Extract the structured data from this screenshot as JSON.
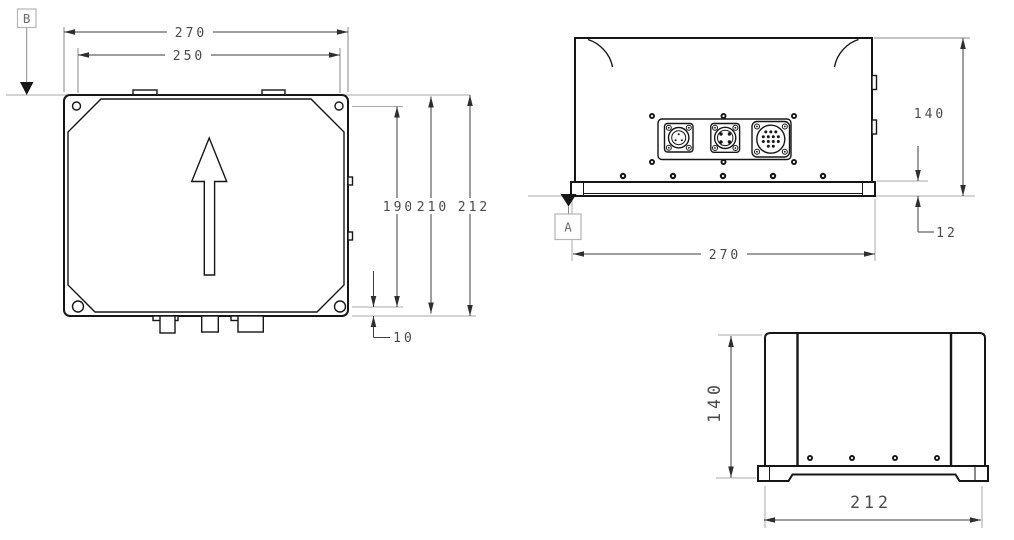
{
  "canvas": {
    "background": "#ffffff",
    "outline_color": "#161616",
    "dimension_line_color": "#3d3d3d",
    "dimension_text_color": "#4a4a4a",
    "extension_line_color": "#a9a9a9"
  },
  "top_view": {
    "datum_label": "B",
    "dim_outer_width": "270",
    "dim_inner_width": "250",
    "dim_hole_span_height": "190",
    "dim_inner_height": "210",
    "dim_overall_height": "212",
    "dim_hole_edge_offset": "10"
  },
  "front_view": {
    "datum_label": "A",
    "dim_overall_height": "140",
    "dim_base_height": "12",
    "dim_overall_width": "270"
  },
  "side_view": {
    "dim_overall_height": "140",
    "dim_overall_width": "212"
  }
}
